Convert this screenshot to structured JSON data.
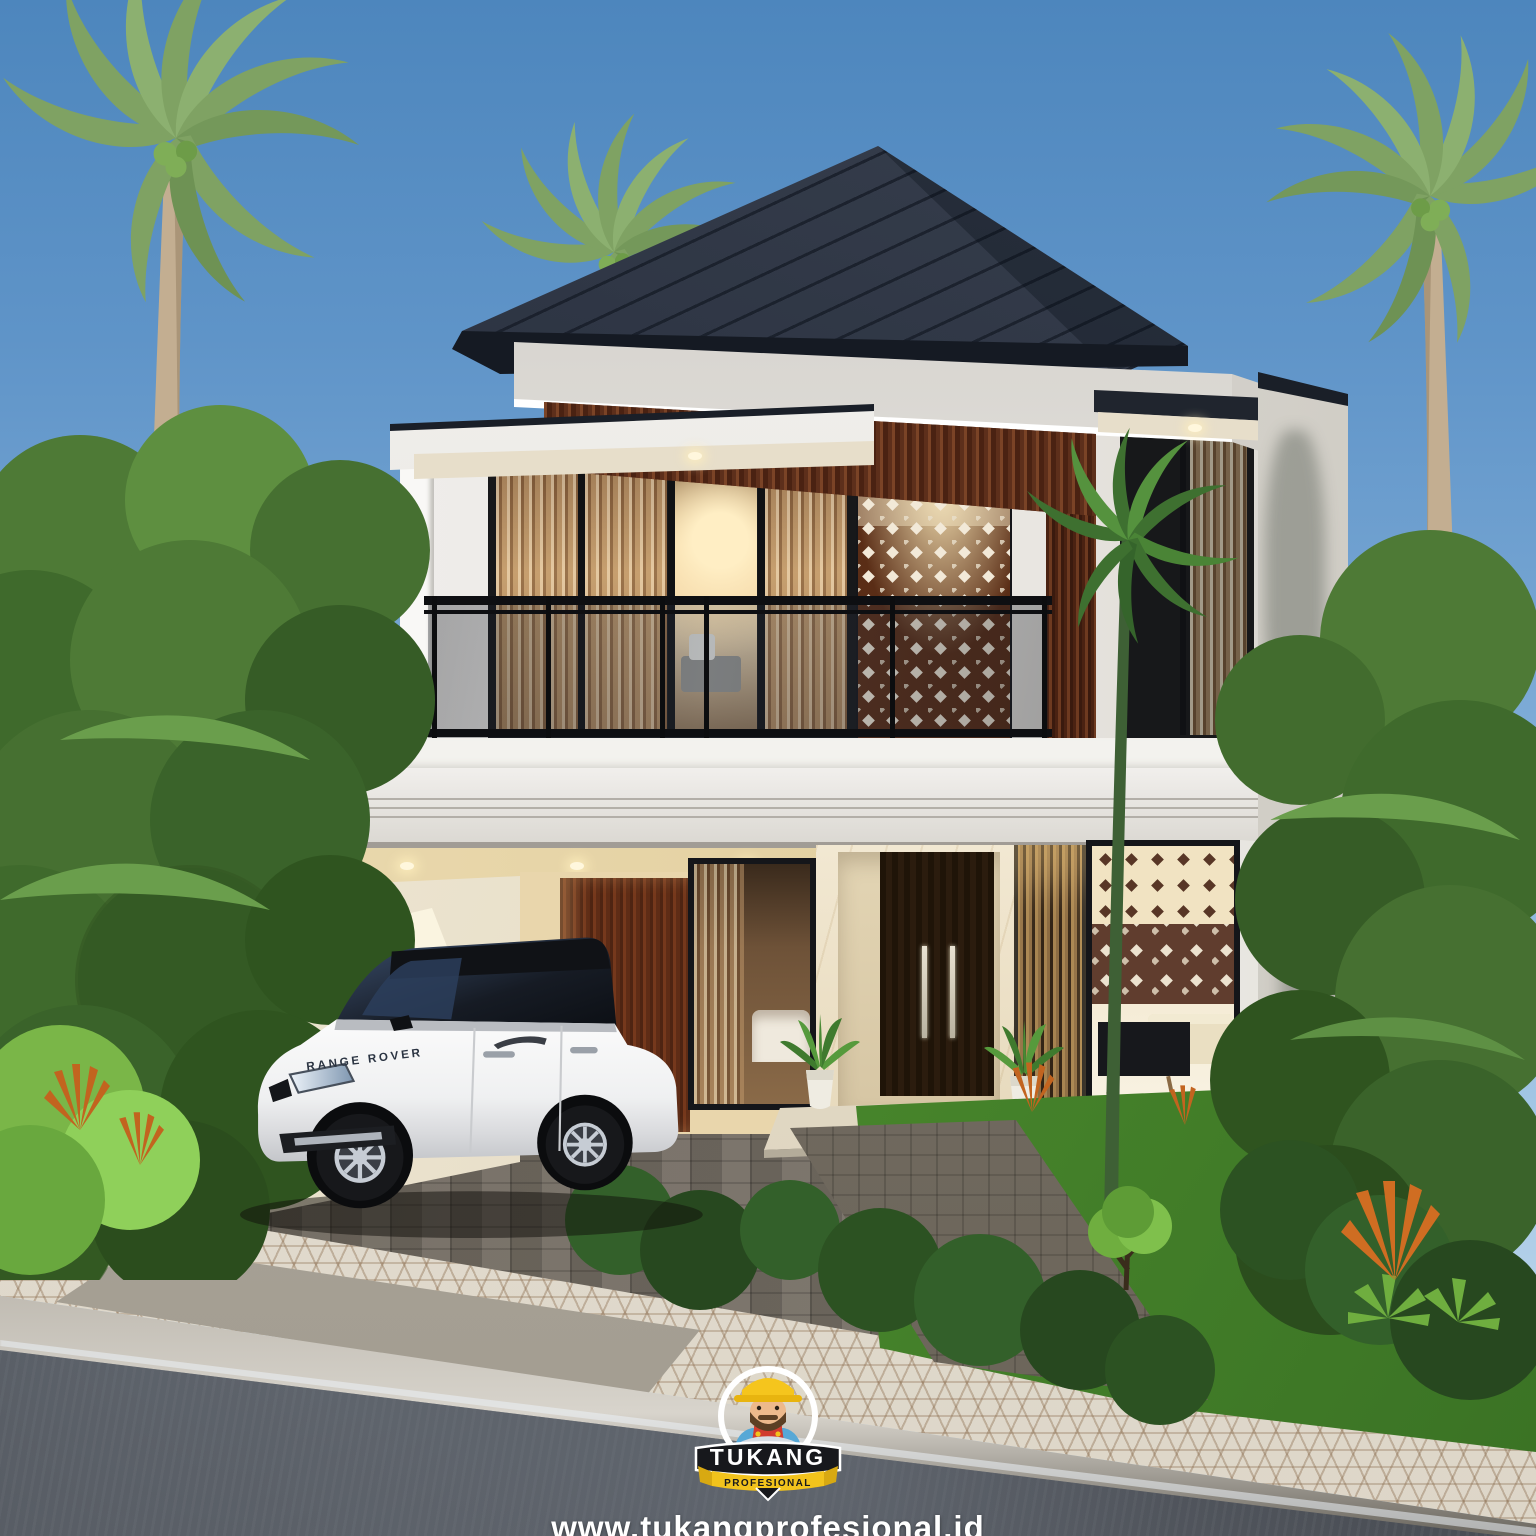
{
  "scene": {
    "description": "3D exterior render of a modern two-story tropical house with carport, balcony, perforated screens and palm trees",
    "car_brand_label": "RANGE ROVER"
  },
  "watermark": {
    "logo_title": "TUKANG",
    "logo_subtitle": "PROFESIONAL",
    "website": "www.tukangprofesional.id",
    "tagline": "Make Your Home Excellent"
  },
  "colors": {
    "sky_top": "#4d86bd",
    "sky_horizon": "#bdd6eb",
    "roof": "#2a3140",
    "wall_white": "#eceae6",
    "wood_accent": "#63321c",
    "interior_glow": "#f7e6bc",
    "frame_black": "#17181a",
    "grass": "#4c8c2e",
    "foliage": "#4e7a36",
    "paver_gray": "#736c62",
    "sidewalk": "#ece7dd",
    "asphalt": "#3c4046",
    "car_body": "#f2f3f4",
    "logo_yellow": "#f2c31c",
    "logo_banner": "#17181c",
    "logo_red": "#d13b30",
    "logo_blue": "#57a8d6"
  }
}
